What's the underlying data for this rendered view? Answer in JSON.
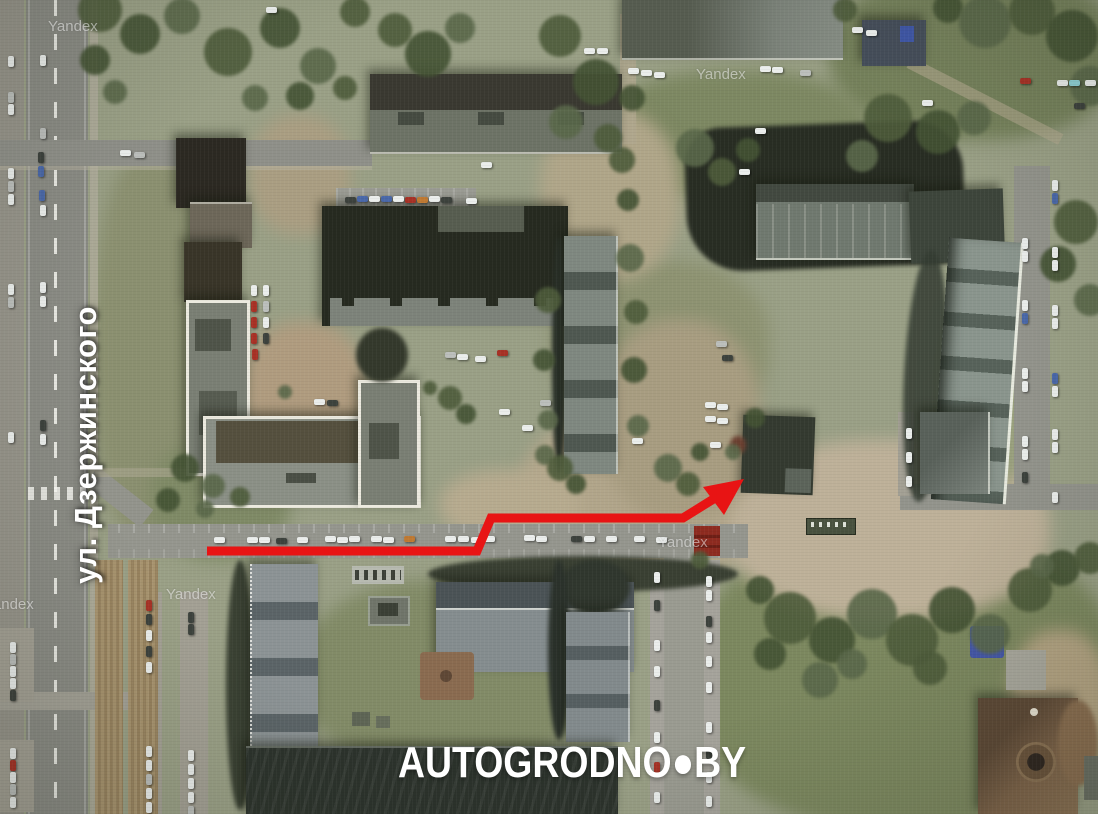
{
  "map": {
    "street_label": "ул. Дзержинского",
    "site_watermark": "AUTOGRODNO●BY",
    "provider_watermark": "Yandex"
  },
  "route_arrow": {
    "color": "#e81414",
    "stroke_width": "9",
    "shaft_points": "207,551 477,551 491,518 683,518 736,485",
    "head_points": "744,479 703,487 724,515"
  }
}
